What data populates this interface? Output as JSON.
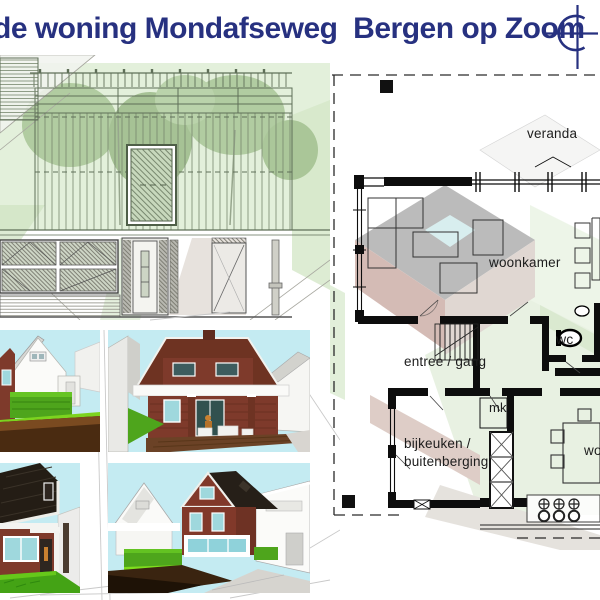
{
  "header": {
    "title": "de woning Mondafseweg  Bergen op Zoom",
    "logo_icon": "compass-crosshair"
  },
  "plan": {
    "labels": {
      "veranda": "veranda",
      "woonkamer": "woonkamer",
      "entree_gang": "entree / gang",
      "wc": "wc",
      "mk": "mk",
      "bijkeuken_line1": "bijkeuken /",
      "bijkeuken_line2": "buitenberging",
      "woonkeuken_clipped": "wo"
    }
  },
  "colors": {
    "title_navy": "#273180",
    "sky": "#c4ebf2",
    "brick": "#7e3a2b",
    "dark_roof": "#26201a",
    "grass": "#4ea51c",
    "lime_grass": "#7fdd1d",
    "soil_brown": "#4a2b11",
    "pale_green_overlay": "#dcecd2",
    "plan_wall": "#0d0d0d",
    "faint_line": "#c9c9c9"
  }
}
